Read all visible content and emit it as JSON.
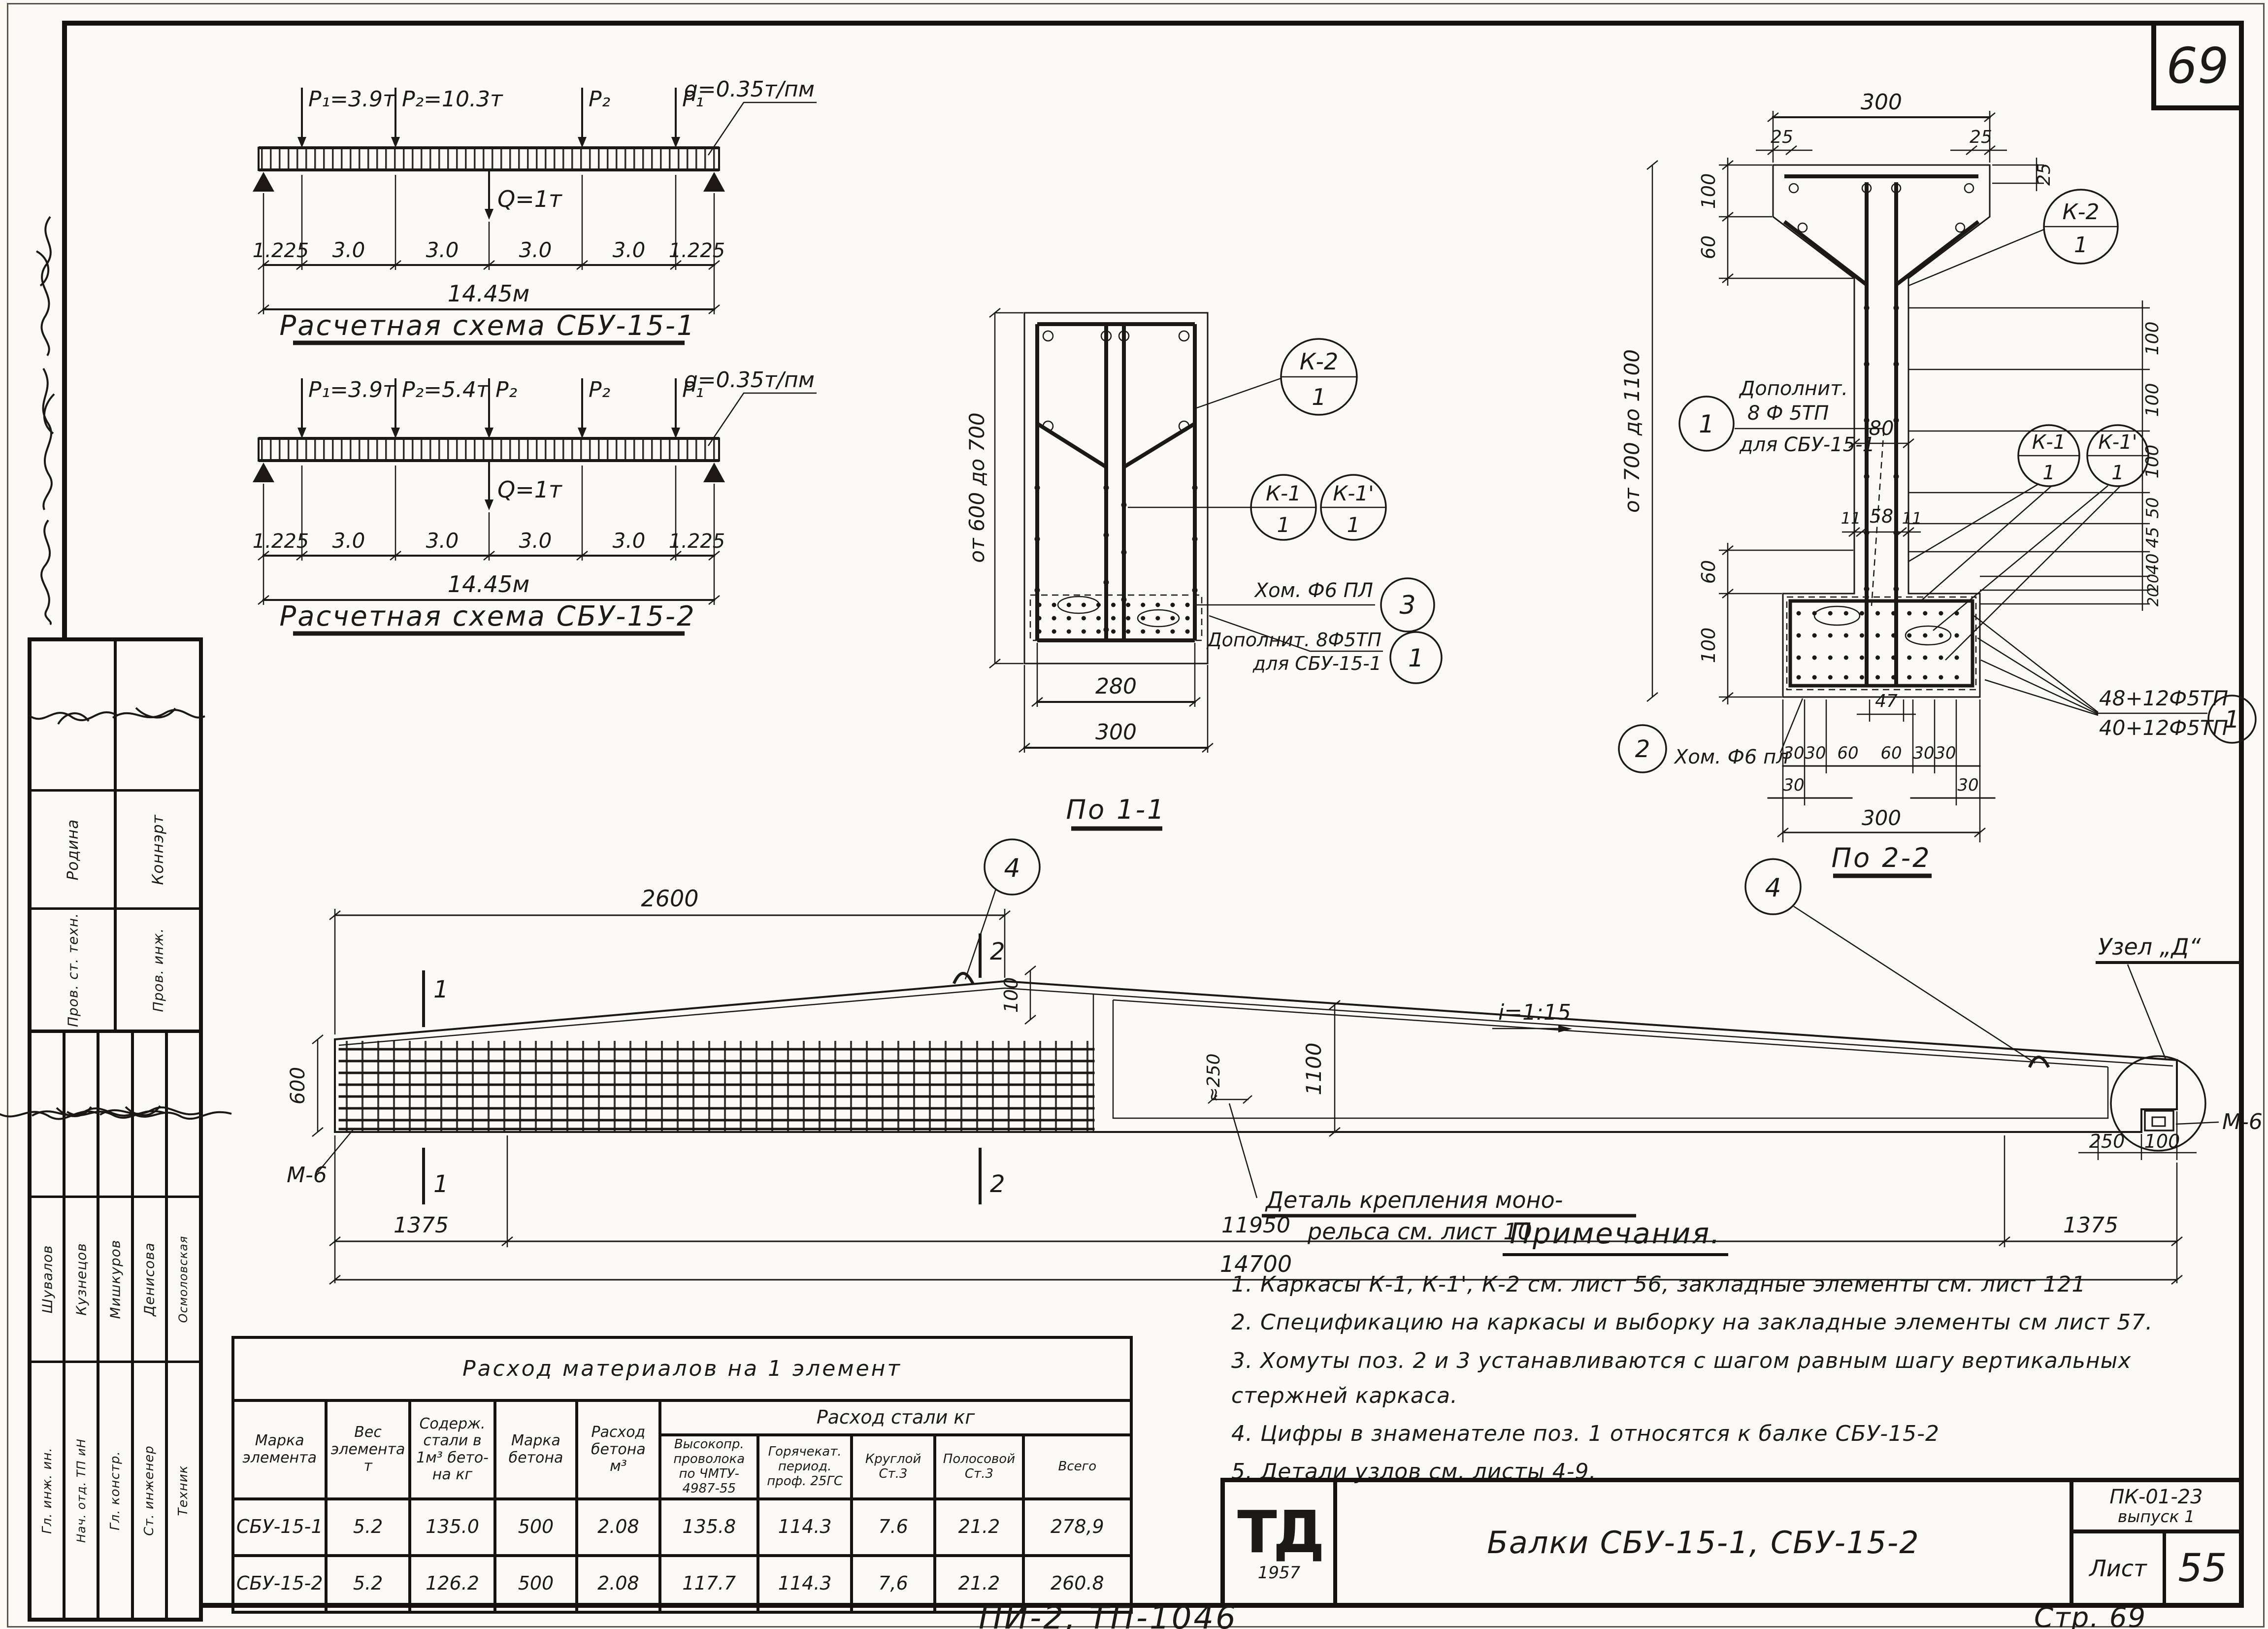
{
  "page": {
    "badge": "69",
    "footer_doc": "ПИ-2, ТП-1046",
    "footer_page": "Стр. 69"
  },
  "schema1": {
    "title": "Расчетная схема СБУ-15-1",
    "q_label": "q=0.35т/пм",
    "Q_label": "Q=1т",
    "loads": [
      "P₁=3.9т",
      "P₂=10.3т",
      "P₂",
      "P₁"
    ],
    "dims": [
      "1.225",
      "3.0",
      "3.0",
      "3.0",
      "3.0",
      "1.225"
    ],
    "total": "14.45м"
  },
  "schema2": {
    "title": "Расчетная схема СБУ-15-2",
    "q_label": "q=0.35т/пм",
    "Q_label": "Q=1т",
    "loads": [
      "P₁=3.9т",
      "P₂=5.4т",
      "P₂",
      "P₂",
      "P₁"
    ],
    "dims": [
      "1.225",
      "3.0",
      "3.0",
      "3.0",
      "3.0",
      "1.225"
    ],
    "total": "14.45м"
  },
  "section11": {
    "title": "По 1-1",
    "height_label": "от 600 до 700",
    "dim_inner": "280",
    "dim_outer": "300",
    "k2": {
      "top": "К-2",
      "bot": "1"
    },
    "k1": {
      "top": "К-1",
      "bot": "1"
    },
    "k1p": {
      "top": "К-1'",
      "bot": "1"
    },
    "stirrup_label": "Хом. Ф6 ПЛ",
    "stirrup_pos": "3",
    "extra_line1": "Дополнит. 8Ф5ТП",
    "extra_line2": "для СБУ-15-1",
    "extra_pos": "1"
  },
  "section22": {
    "title": "По 2-2",
    "top_300": "300",
    "top_25l": "25",
    "top_25r": "25",
    "right_25": "25",
    "left_100t": "100",
    "left_60t": "60",
    "height_label": "от 700 до 1100",
    "left_60b": "60",
    "left_100b": "100",
    "web_80": "80",
    "web_11l": "11",
    "web_58": "58",
    "web_11r": "11",
    "right_dims": [
      "100",
      "100",
      "100",
      "50",
      "45",
      "40",
      "20",
      "20"
    ],
    "k2": {
      "top": "К-2",
      "bot": "1"
    },
    "k1": {
      "top": "К-1",
      "bot": "1"
    },
    "k1p": {
      "top": "К-1'",
      "bot": "1"
    },
    "extra_pos": "1",
    "extra_line1": "Дополнит.",
    "extra_line2": "8 Ф 5ТП",
    "extra_line3": "для СБУ-15-1",
    "stirrup_pos": "2",
    "stirrup_label": "Хом. Ф6 пл",
    "wires_top": "48+12Ф5ТП",
    "wires_bot": "40+12Ф5ТП",
    "wires_pos": "1",
    "bot_dims": [
      "30",
      "30",
      "60",
      "60",
      "30",
      "30"
    ],
    "bot_dims2": [
      "30",
      "30"
    ],
    "dim_47": "47",
    "bot_300": "300"
  },
  "elevation": {
    "dim_2600": "2600",
    "dim_100": "100",
    "callout_4": "4",
    "slope": "i=1:15",
    "dim_1100": "1100",
    "dim_250_approx": "≈250",
    "dim_600": "600",
    "note_line1": "Деталь крепления моно-",
    "note_line2": "рельса см. лист 10",
    "node_label": "Узел „Д“",
    "m6": "М-6",
    "dim_250": "250",
    "dim_100r": "100",
    "d_left": "1375",
    "d_mid": "11950",
    "d_right": "1375",
    "total": "14700",
    "mark1": "1",
    "mark2": "2"
  },
  "notes": {
    "title": "Примечания.",
    "items": [
      "1. Каркасы К-1, К-1', К-2 см. лист 56, закладные элементы см. лист 121",
      "2. Спецификацию на каркасы и выборку на закладные элементы см лист 57.",
      "3. Хомуты поз. 2 и 3 устанавливаются с шагом равным шагу вертикальных стержней каркаса.",
      "4. Цифры в знаменателе поз. 1 относятся к балке СБУ-15-2",
      "5. Детали узлов см. листы 4-9."
    ]
  },
  "table": {
    "title": "Расход материалов на 1 элемент",
    "h_marka": "Марка\nэлемента",
    "h_ves": "Вес\nэлемента\nт",
    "h_sod": "Содерж.\nстали в\n1м³ бето-\nна кг",
    "h_marka_bet": "Марка\nбетона",
    "h_rashod_bet": "Расход\nбетона\nм³",
    "h_steel": "Расход стали кг",
    "h_s1": "Высокопр.\nпроволока\nпо ЧМТУ-\n4987-55",
    "h_s2": "Горячекат.\nпериод.\nпроф. 25ГС",
    "h_s3": "Круглой\nСт.3",
    "h_s4": "Полосовой\nСт.3",
    "h_s5": "Всего",
    "rows": [
      [
        "СБУ-15-1",
        "5.2",
        "135.0",
        "500",
        "2.08",
        "135.8",
        "114.3",
        "7.6",
        "21.2",
        "278,9"
      ],
      [
        "СБУ-15-2",
        "5.2",
        "126.2",
        "500",
        "2.08",
        "117.7",
        "114.3",
        "7,6",
        "21.2",
        "260.8"
      ]
    ]
  },
  "title_block": {
    "logo": "ТД",
    "year": "1957",
    "title": "Балки СБУ-15-1, СБУ-15-2",
    "code1": "ПК-01-23",
    "code2": "выпуск 1",
    "sheet_label": "Лист",
    "sheet_no": "55"
  },
  "stamp": {
    "groupA": [
      {
        "role": "Пров. ст. техн.",
        "name": "Родина"
      },
      {
        "role": "Пров. инж.",
        "name": "Коннэрт"
      }
    ],
    "groupB": [
      {
        "role": "Гл. инж. ин.",
        "name": "Шувалов"
      },
      {
        "role": "Нач. отд. ТП иН",
        "name": "Кузнецов"
      },
      {
        "role": "Гл. констр.",
        "name": "Мишкуров"
      },
      {
        "role": "Ст. инженер",
        "name": "Денисова"
      },
      {
        "role": "Техник",
        "name": "Осмоловская"
      }
    ]
  }
}
